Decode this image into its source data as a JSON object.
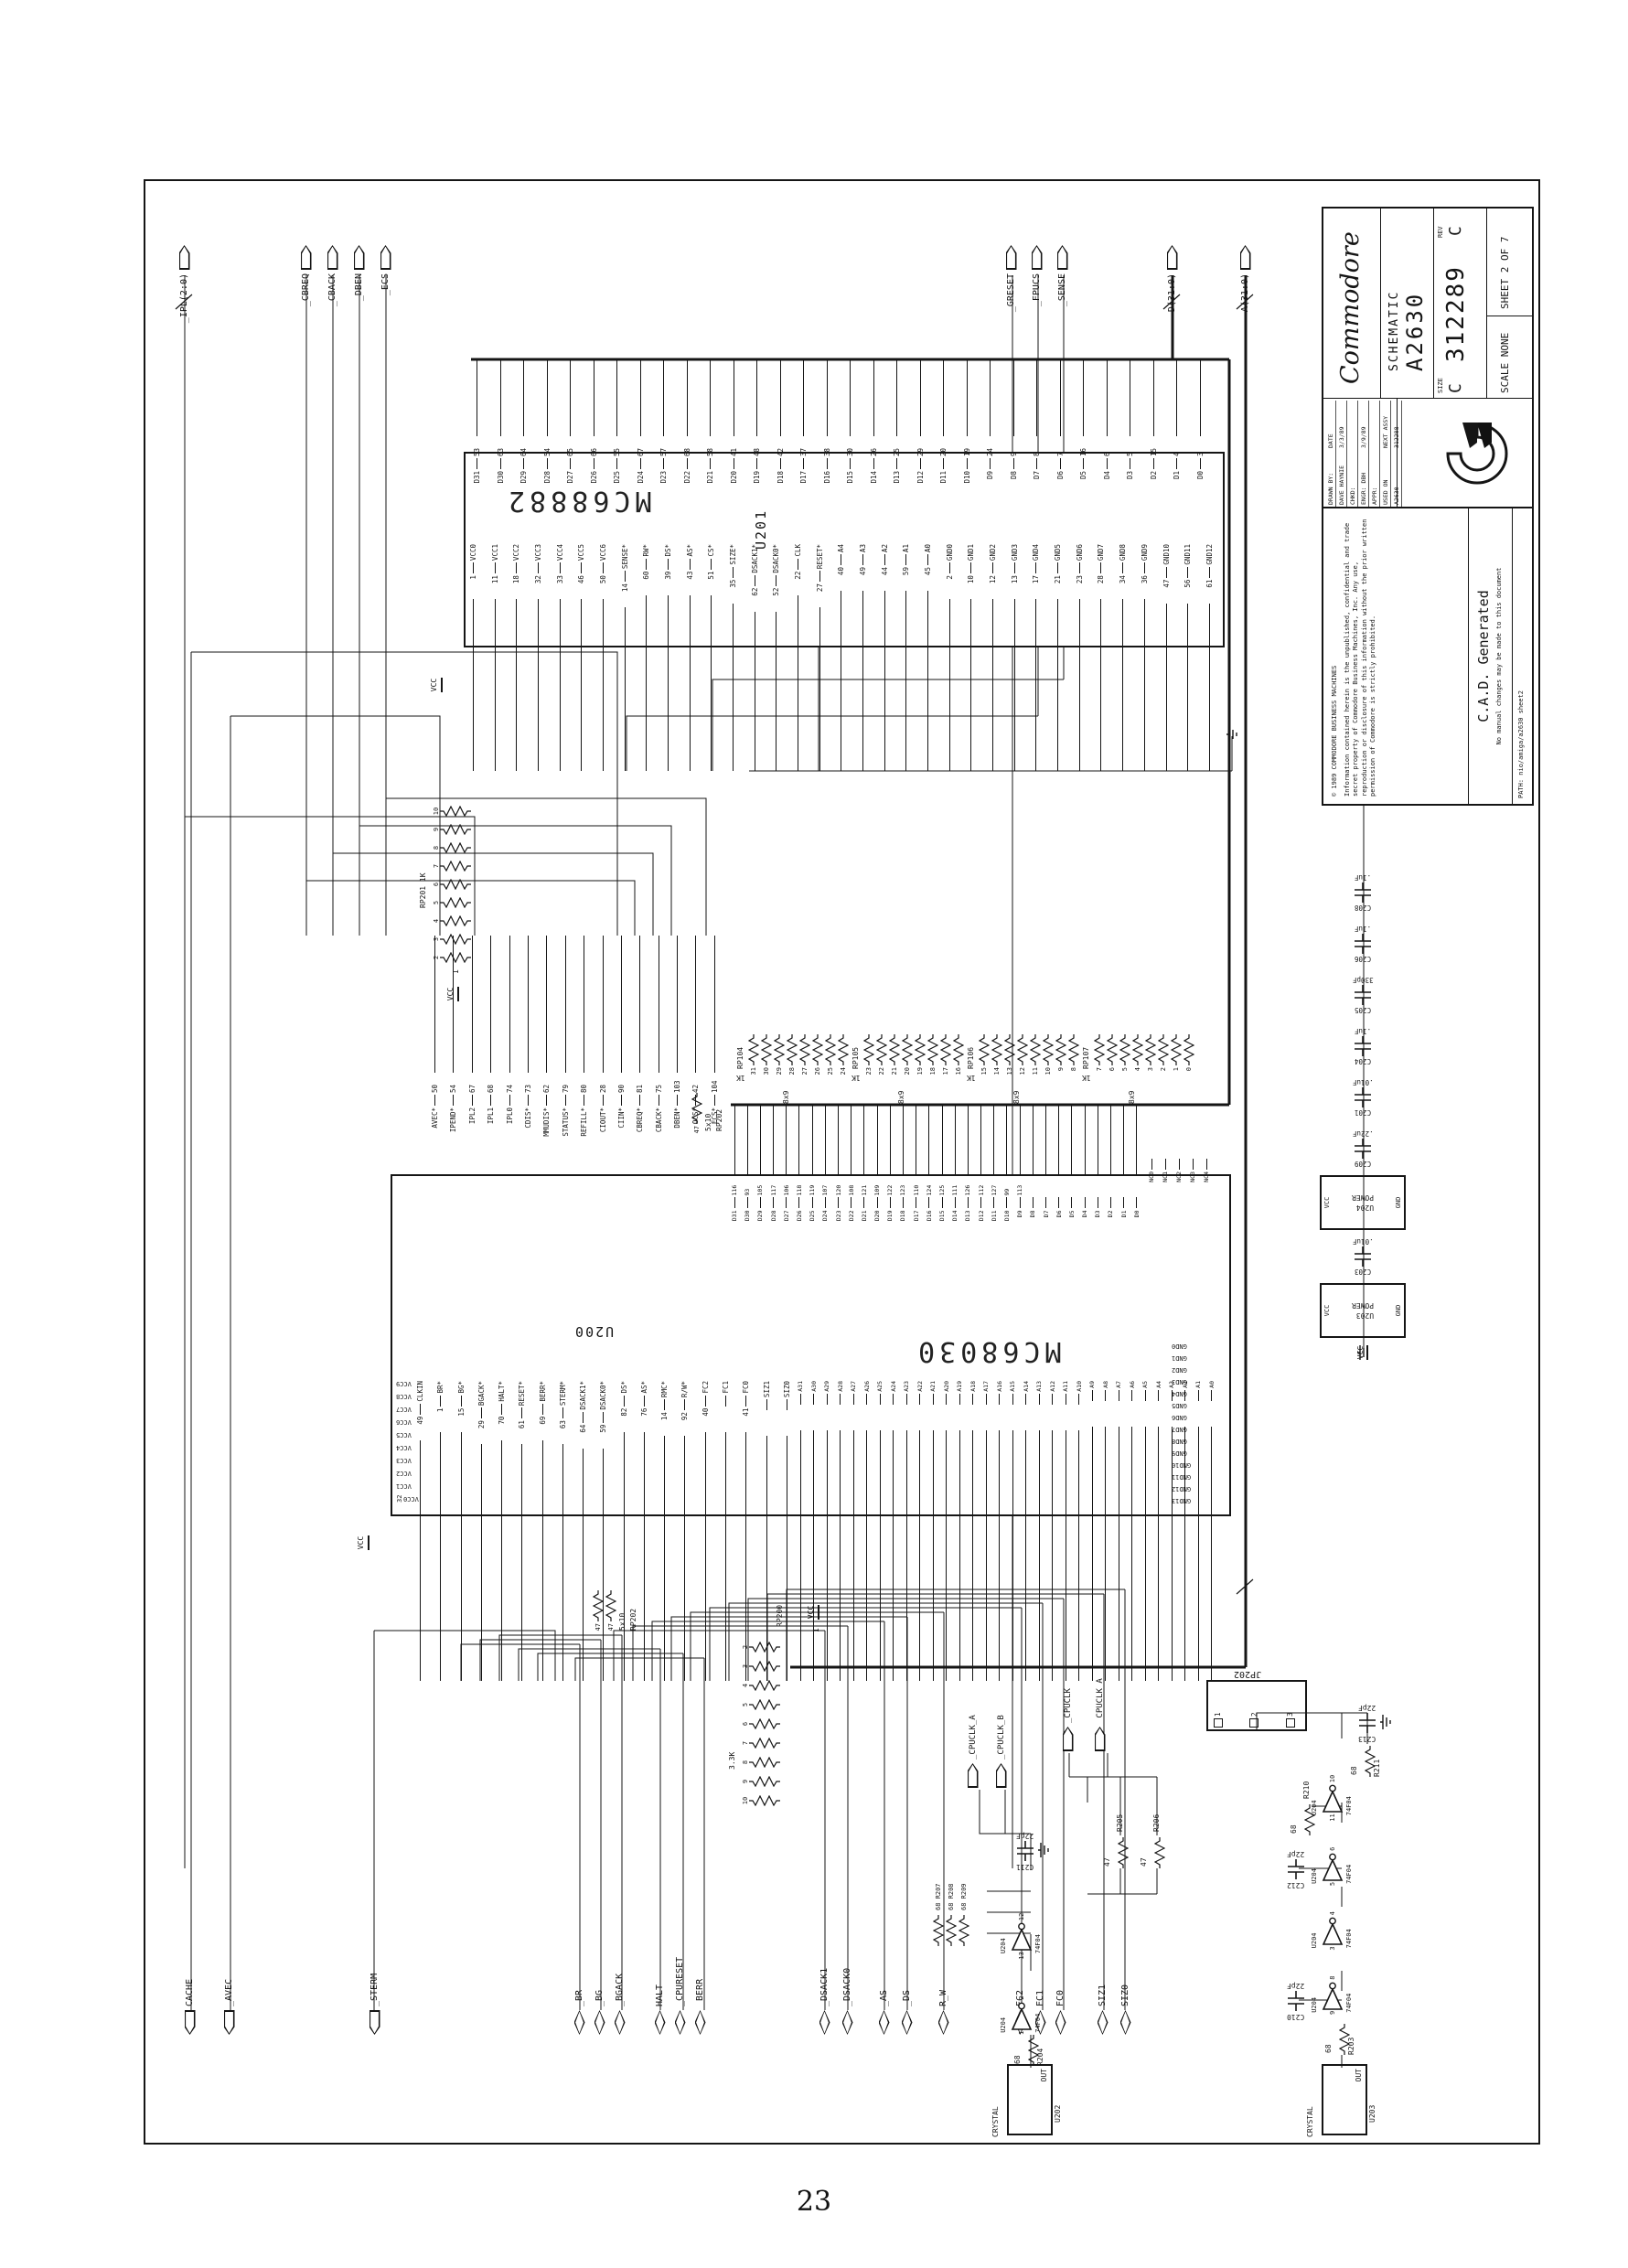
{
  "page_number": "23",
  "title_block": {
    "brand": "Commodore",
    "product_line1": "SCHEMATIC",
    "product_line2": "A2630",
    "size_label": "SIZE",
    "size": "C",
    "doc_number": "312289",
    "rev_label": "REV",
    "rev": "C",
    "scale": "SCALE NONE",
    "sheet": "SHEET 2 OF 7",
    "table": {
      "r1c1": "DRAWN BY:",
      "r1c2": "DATE",
      "r2c1": "DAVE HAYNIE",
      "r2c2": "3/3/89",
      "r3c1": "CHKD:",
      "r3c2": "",
      "r4c1": "ENGR: DBH",
      "r4c2": "3/9/89",
      "r5c1": "APPR:",
      "r5c2": "",
      "r6c1": "USED ON",
      "r6c2": "NEXT ASSY",
      "r7c1": "A2630",
      "r7c2": "312288"
    },
    "path": "PATH: nio/amiga/a2630 sheet2"
  },
  "copyright": {
    "line1": "© 1989 COMMODORE BUSINESS MACHINES",
    "body": "Information contained herein is the unpublished, confidential and trade secret property of Commodore Business Machines, Inc. Any use, reproduction or disclosure of this information without the prior written permission of Commodore is strictly prohibited.",
    "cad": "C.A.D. Generated",
    "cad_note": "No manual changes may be made to this document"
  },
  "connectors": {
    "left": [
      [
        "CACHE",
        "_AVEC"
      ],
      [
        "_STERM"
      ],
      [
        "_BR",
        "_BG",
        "_BGACK"
      ],
      [
        "HALT",
        "_CPURESET",
        "_BERR"
      ],
      [
        "_DSACK1",
        "_DSACK0"
      ],
      [
        "_AS",
        "_DS"
      ],
      [
        "R_W"
      ],
      [
        "FC2",
        "FC1",
        "FC0"
      ],
      [
        "SIZ1",
        "SIZ0"
      ]
    ],
    "right": [
      [
        "_IPL(2:0)"
      ],
      [
        "_CBREQ",
        "_CBACK",
        "_DBEN",
        "_ECS"
      ],
      [
        "_GRESET",
        "_FPUCS",
        "_SENSE"
      ],
      [
        "D(31:0)"
      ],
      [
        "A(31:0)"
      ]
    ]
  },
  "u200": {
    "ref": "U200",
    "part": "MC68030",
    "right_ctrl": [
      [
        "50",
        "AVEC*"
      ],
      [
        "54",
        "IPEND*"
      ],
      [
        "67",
        "IPL2"
      ],
      [
        "68",
        "IPL1"
      ],
      [
        "74",
        "IPL0"
      ],
      [
        "73",
        "CDIS*"
      ],
      [
        "62",
        "MMUDIS*"
      ],
      [
        "79",
        "STATUS*"
      ],
      [
        "80",
        "REFILL*"
      ],
      [
        "28",
        "CIOUT*"
      ],
      [
        "90",
        "CIIN*"
      ],
      [
        "81",
        "CBREQ*"
      ],
      [
        "75",
        "CBACK*"
      ],
      [
        "103",
        "DBEN*"
      ],
      [
        "42",
        "OCS*"
      ],
      [
        "104",
        "ECS*"
      ]
    ],
    "right_data": [
      [
        "116",
        "D31"
      ],
      [
        "93",
        "D30"
      ],
      [
        "105",
        "D29"
      ],
      [
        "117",
        "D28"
      ],
      [
        "106",
        "D27"
      ],
      [
        "118",
        "D26"
      ],
      [
        "119",
        "D25"
      ],
      [
        "107",
        "D24"
      ],
      [
        "120",
        "D23"
      ],
      [
        "108",
        "D22"
      ],
      [
        "121",
        "D21"
      ],
      [
        "109",
        "D20"
      ],
      [
        "122",
        "D19"
      ],
      [
        "123",
        "D18"
      ],
      [
        "110",
        "D17"
      ],
      [
        "124",
        "D16"
      ],
      [
        "125",
        "D15"
      ],
      [
        "111",
        "D14"
      ],
      [
        "126",
        "D13"
      ],
      [
        "112",
        "D12"
      ],
      [
        "127",
        "D11"
      ],
      [
        "99",
        "D10"
      ],
      [
        "113",
        "D9"
      ],
      [
        "",
        "D8"
      ],
      [
        "",
        "D7"
      ],
      [
        "",
        "D6"
      ],
      [
        "",
        "D5"
      ],
      [
        "",
        "D4"
      ],
      [
        "",
        "D3"
      ],
      [
        "",
        "D2"
      ],
      [
        "",
        "D1"
      ],
      [
        "",
        "D0"
      ]
    ],
    "right_nc": [
      [
        "",
        "NC0"
      ],
      [
        "",
        "NC1"
      ],
      [
        "",
        "NC2"
      ],
      [
        "",
        "NC3"
      ],
      [
        "",
        "NC4"
      ]
    ],
    "left_ctrl": [
      [
        "49",
        "CLKIN"
      ],
      [
        "1",
        "BR*"
      ],
      [
        "15",
        "BG*"
      ],
      [
        "29",
        "BGACK*"
      ],
      [
        "70",
        "HALT*"
      ],
      [
        "61",
        "RESET*"
      ],
      [
        "69",
        "BERR*"
      ],
      [
        "63",
        "STERM*"
      ],
      [
        "64",
        "DSACK1*"
      ],
      [
        "59",
        "DSACK0*"
      ],
      [
        "82",
        "DS*"
      ],
      [
        "76",
        "AS*"
      ],
      [
        "14",
        "RMC*"
      ],
      [
        "92",
        "R/W*"
      ],
      [
        "40",
        "FC2"
      ],
      [
        "",
        "FC1"
      ],
      [
        "41",
        "FC0"
      ],
      [
        "",
        "SIZ1"
      ],
      [
        "",
        "SIZ0"
      ]
    ],
    "left_addr": [
      [
        "",
        "A31"
      ],
      [
        "",
        "A30"
      ],
      [
        "",
        "A29"
      ],
      [
        "",
        "A28"
      ],
      [
        "",
        "A27"
      ],
      [
        "",
        "A26"
      ],
      [
        "",
        "A25"
      ],
      [
        "",
        "A24"
      ],
      [
        "",
        "A23"
      ],
      [
        "",
        "A22"
      ],
      [
        "",
        "A21"
      ],
      [
        "",
        "A20"
      ],
      [
        "",
        "A19"
      ],
      [
        "",
        "A18"
      ],
      [
        "",
        "A17"
      ],
      [
        "",
        "A16"
      ],
      [
        "",
        "A15"
      ],
      [
        "",
        "A14"
      ],
      [
        "",
        "A13"
      ],
      [
        "",
        "A12"
      ],
      [
        "",
        "A11"
      ],
      [
        "",
        "A10"
      ],
      [
        "",
        "A9"
      ],
      [
        "",
        "A8"
      ],
      [
        "",
        "A7"
      ],
      [
        "",
        "A6"
      ],
      [
        "",
        "A5"
      ],
      [
        "",
        "A4"
      ],
      [
        "",
        "A3"
      ],
      [
        "",
        "A2"
      ],
      [
        "",
        "A1"
      ],
      [
        "",
        "A0"
      ]
    ],
    "top_vcc": [
      [
        "32",
        "VCC0"
      ],
      [
        "",
        "VCC1"
      ],
      [
        "",
        "VCC2"
      ],
      [
        "",
        "VCC3"
      ],
      [
        "",
        "VCC4"
      ],
      [
        "",
        "VCC5"
      ],
      [
        "",
        "VCC6"
      ],
      [
        "",
        "VCC7"
      ],
      [
        "",
        "VCC8"
      ],
      [
        "",
        "VCC9"
      ]
    ],
    "bottom_gnd": [
      [
        "",
        "GND13"
      ],
      [
        "",
        "GND12"
      ],
      [
        "",
        "GND11"
      ],
      [
        "",
        "GND10"
      ],
      [
        "",
        "GND9"
      ],
      [
        "",
        "GND8"
      ],
      [
        "",
        "GND7"
      ],
      [
        "",
        "GND6"
      ],
      [
        "",
        "GND5"
      ],
      [
        "",
        "GND4"
      ],
      [
        "",
        "GND3"
      ],
      [
        "",
        "GND2"
      ],
      [
        "",
        "GND1"
      ],
      [
        "",
        "GND0"
      ]
    ]
  },
  "u201": {
    "ref": "U201",
    "part": "MC68882",
    "left_pins": [
      [
        "1",
        "VCC0"
      ],
      [
        "11",
        "VCC1"
      ],
      [
        "18",
        "VCC2"
      ],
      [
        "32",
        "VCC3"
      ],
      [
        "33",
        "VCC4"
      ],
      [
        "46",
        "VCC5"
      ],
      [
        "50",
        "VCC6"
      ],
      [
        "14",
        "SENSE*"
      ],
      [
        "60",
        "RW*"
      ],
      [
        "39",
        "DS*"
      ],
      [
        "43",
        "AS*"
      ],
      [
        "51",
        "CS*"
      ],
      [
        "35",
        "SIZE*"
      ],
      [
        "62",
        "DSACK1*"
      ],
      [
        "52",
        "DSACK0*"
      ],
      [
        "22",
        "CLK"
      ],
      [
        "27",
        "RESET*"
      ],
      [
        "40",
        "A4"
      ],
      [
        "49",
        "A3"
      ],
      [
        "44",
        "A2"
      ],
      [
        "59",
        "A1"
      ],
      [
        "45",
        "A0"
      ],
      [
        "2",
        "GND0"
      ],
      [
        "10",
        "GND1"
      ],
      [
        "12",
        "GND2"
      ],
      [
        "13",
        "GND3"
      ],
      [
        "17",
        "GND4"
      ],
      [
        "21",
        "GND5"
      ],
      [
        "23",
        "GND6"
      ],
      [
        "28",
        "GND7"
      ],
      [
        "34",
        "GND8"
      ],
      [
        "36",
        "GND9"
      ],
      [
        "47",
        "GND10"
      ],
      [
        "56",
        "GND11"
      ],
      [
        "61",
        "GND12"
      ]
    ],
    "right_pins": [
      [
        "53",
        "D31"
      ],
      [
        "63",
        "D30"
      ],
      [
        "64",
        "D29"
      ],
      [
        "54",
        "D28"
      ],
      [
        "65",
        "D27"
      ],
      [
        "66",
        "D26"
      ],
      [
        "55",
        "D25"
      ],
      [
        "67",
        "D24"
      ],
      [
        "57",
        "D23"
      ],
      [
        "68",
        "D22"
      ],
      [
        "58",
        "D21"
      ],
      [
        "41",
        "D20"
      ],
      [
        "48",
        "D19"
      ],
      [
        "42",
        "D18"
      ],
      [
        "37",
        "D17"
      ],
      [
        "38",
        "D16"
      ],
      [
        "30",
        "D15"
      ],
      [
        "26",
        "D14"
      ],
      [
        "25",
        "D13"
      ],
      [
        "29",
        "D12"
      ],
      [
        "20",
        "D11"
      ],
      [
        "19",
        "D10"
      ],
      [
        "24",
        "D9"
      ],
      [
        "9",
        "D8"
      ],
      [
        "8",
        "D7"
      ],
      [
        "7",
        "D6"
      ],
      [
        "16",
        "D5"
      ],
      [
        "6",
        "D4"
      ],
      [
        "5",
        "D3"
      ],
      [
        "15",
        "D2"
      ],
      [
        "4",
        "D1"
      ],
      [
        "3",
        "D0"
      ]
    ]
  },
  "packs": {
    "rp104": {
      "ref": "RP104",
      "value": "1K",
      "size": "8x9",
      "bits": [
        "31",
        "30",
        "29",
        "28",
        "27",
        "26",
        "25",
        "24"
      ]
    },
    "rp105": {
      "ref": "RP105",
      "value": "1K",
      "size": "8x9",
      "bits": [
        "23",
        "22",
        "21",
        "20",
        "19",
        "18",
        "17",
        "16"
      ]
    },
    "rp106": {
      "ref": "RP106",
      "value": "1K",
      "size": "8x9",
      "bits": [
        "15",
        "14",
        "13",
        "12",
        "11",
        "10",
        "9",
        "8"
      ]
    },
    "rp107": {
      "ref": "RP107",
      "value": "1K",
      "size": "8x9",
      "bits": [
        "7",
        "6",
        "5",
        "4",
        "3",
        "2",
        "1",
        "0"
      ]
    },
    "rp201": {
      "ref": "RP201",
      "value": "1K",
      "common_pin": "1",
      "pins": [
        "2",
        "3",
        "4",
        "5",
        "6",
        "7",
        "8",
        "9",
        "10"
      ]
    },
    "rp200": {
      "ref": "RP200",
      "value": "3.3K",
      "common_pin": "1",
      "pins": [
        "10",
        "9",
        "8",
        "7",
        "6",
        "5",
        "4",
        "3",
        "2"
      ]
    },
    "rp202a": {
      "ref": "RP202",
      "size": "5x10",
      "values": [
        "47",
        "47"
      ]
    },
    "rp202b": {
      "ref": "RP202",
      "size": "5x10",
      "values": [
        "47"
      ]
    }
  },
  "caps_a": [
    [
      "C203",
      ".01uF"
    ]
  ],
  "caps_b": [
    [
      "C209",
      ".22uF"
    ],
    [
      "C201",
      ".01uF"
    ],
    [
      "C204",
      ".1uF"
    ],
    [
      "C205",
      "330pF"
    ],
    [
      "C206",
      ".1uF"
    ],
    [
      "C208",
      ".1uF"
    ]
  ],
  "power_blocks": {
    "a": {
      "ref": "U203",
      "label": "POWER",
      "vcc": "VCC",
      "gnd": "GND"
    },
    "b": {
      "ref": "U204",
      "label": "POWER",
      "vcc": "VCC",
      "gnd": "GND"
    }
  },
  "clock": {
    "inv_ref": "U204",
    "inv_part": "74F04",
    "gates_a": [
      [
        "1",
        "2"
      ],
      [
        "13",
        "12"
      ]
    ],
    "gates_b": [
      [
        "9",
        "8"
      ],
      [
        "3",
        "4"
      ],
      [
        "5",
        "6"
      ],
      [
        "11",
        "10"
      ]
    ],
    "r203": [
      "R203",
      "68"
    ],
    "r204": [
      "R204",
      "68"
    ],
    "trio": [
      [
        "R207",
        "68"
      ],
      [
        "R208",
        "68"
      ],
      [
        "R209",
        "68"
      ]
    ],
    "r210": [
      "R210",
      "68"
    ],
    "r211": [
      "R211",
      "68"
    ],
    "r205": [
      "R205",
      "47"
    ],
    "r206": [
      "R206",
      "47"
    ],
    "c210": [
      "C210",
      "22pF"
    ],
    "c211": [
      "C211",
      "22pF"
    ],
    "c212": [
      "C212",
      "22pF"
    ],
    "c213": [
      "C213",
      "22pF"
    ],
    "outputs_a": [
      "_CPUCLK_A",
      "_CPUCLK_B"
    ],
    "outputs_b": [
      "_CPUCLK",
      "_CPUCLK_A"
    ],
    "xtal_a": {
      "ref": "U202",
      "label": "CRYSTAL",
      "pin": "OUT"
    },
    "xtal_b": {
      "ref": "U203",
      "label": "CRYSTAL",
      "pin": "OUT"
    },
    "jp": {
      "ref": "JP202",
      "pins": [
        "1",
        "2",
        "3"
      ]
    }
  },
  "labels": {
    "vcc": "VCC"
  }
}
